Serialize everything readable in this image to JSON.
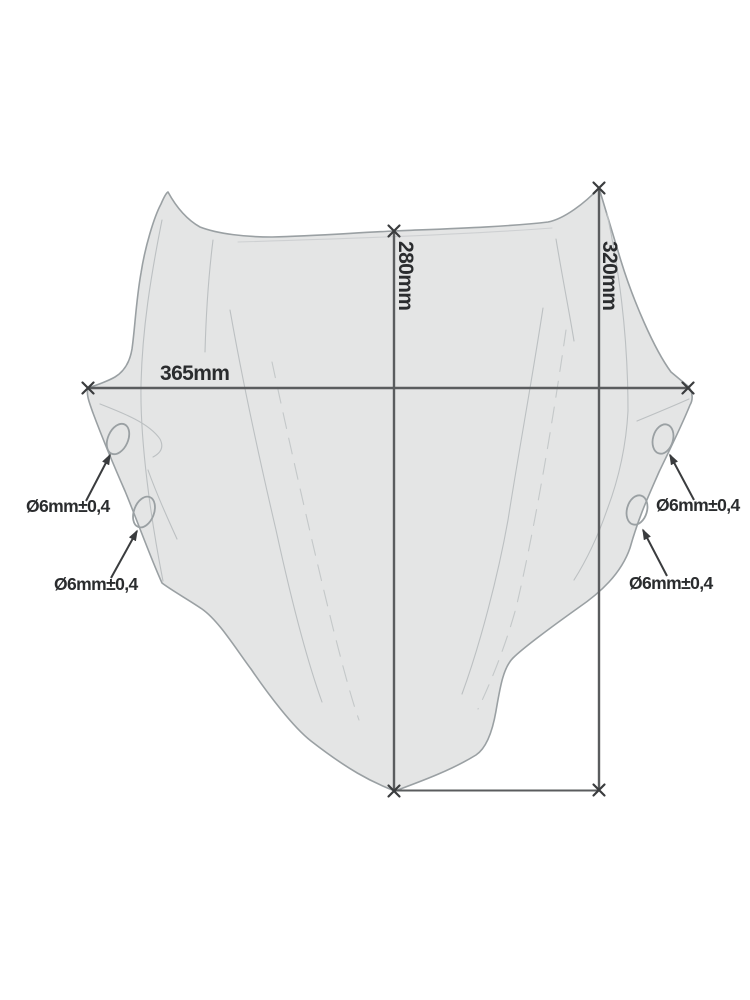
{
  "diagram": {
    "subject": "motorcycle-windscreen-dimension-drawing",
    "dimensions": {
      "width": "365mm",
      "height_center": "280mm",
      "height_side": "320mm"
    },
    "holes": [
      {
        "position": "left-upper",
        "label": "Ø6mm±0,4"
      },
      {
        "position": "left-lower",
        "label": "Ø6mm±0,4"
      },
      {
        "position": "right-upper",
        "label": "Ø6mm±0,4"
      },
      {
        "position": "right-lower",
        "label": "Ø6mm±0,4"
      }
    ],
    "colors": {
      "background": "#ffffff",
      "shape_fill": "#e4e5e5",
      "shape_outline": "#9aa0a3",
      "crease_line": "#bcc0c2",
      "dimension_line": "#5a5c5e",
      "marker_and_arrow": "#3a3c3e",
      "label_text": "#2a2c2e"
    }
  }
}
